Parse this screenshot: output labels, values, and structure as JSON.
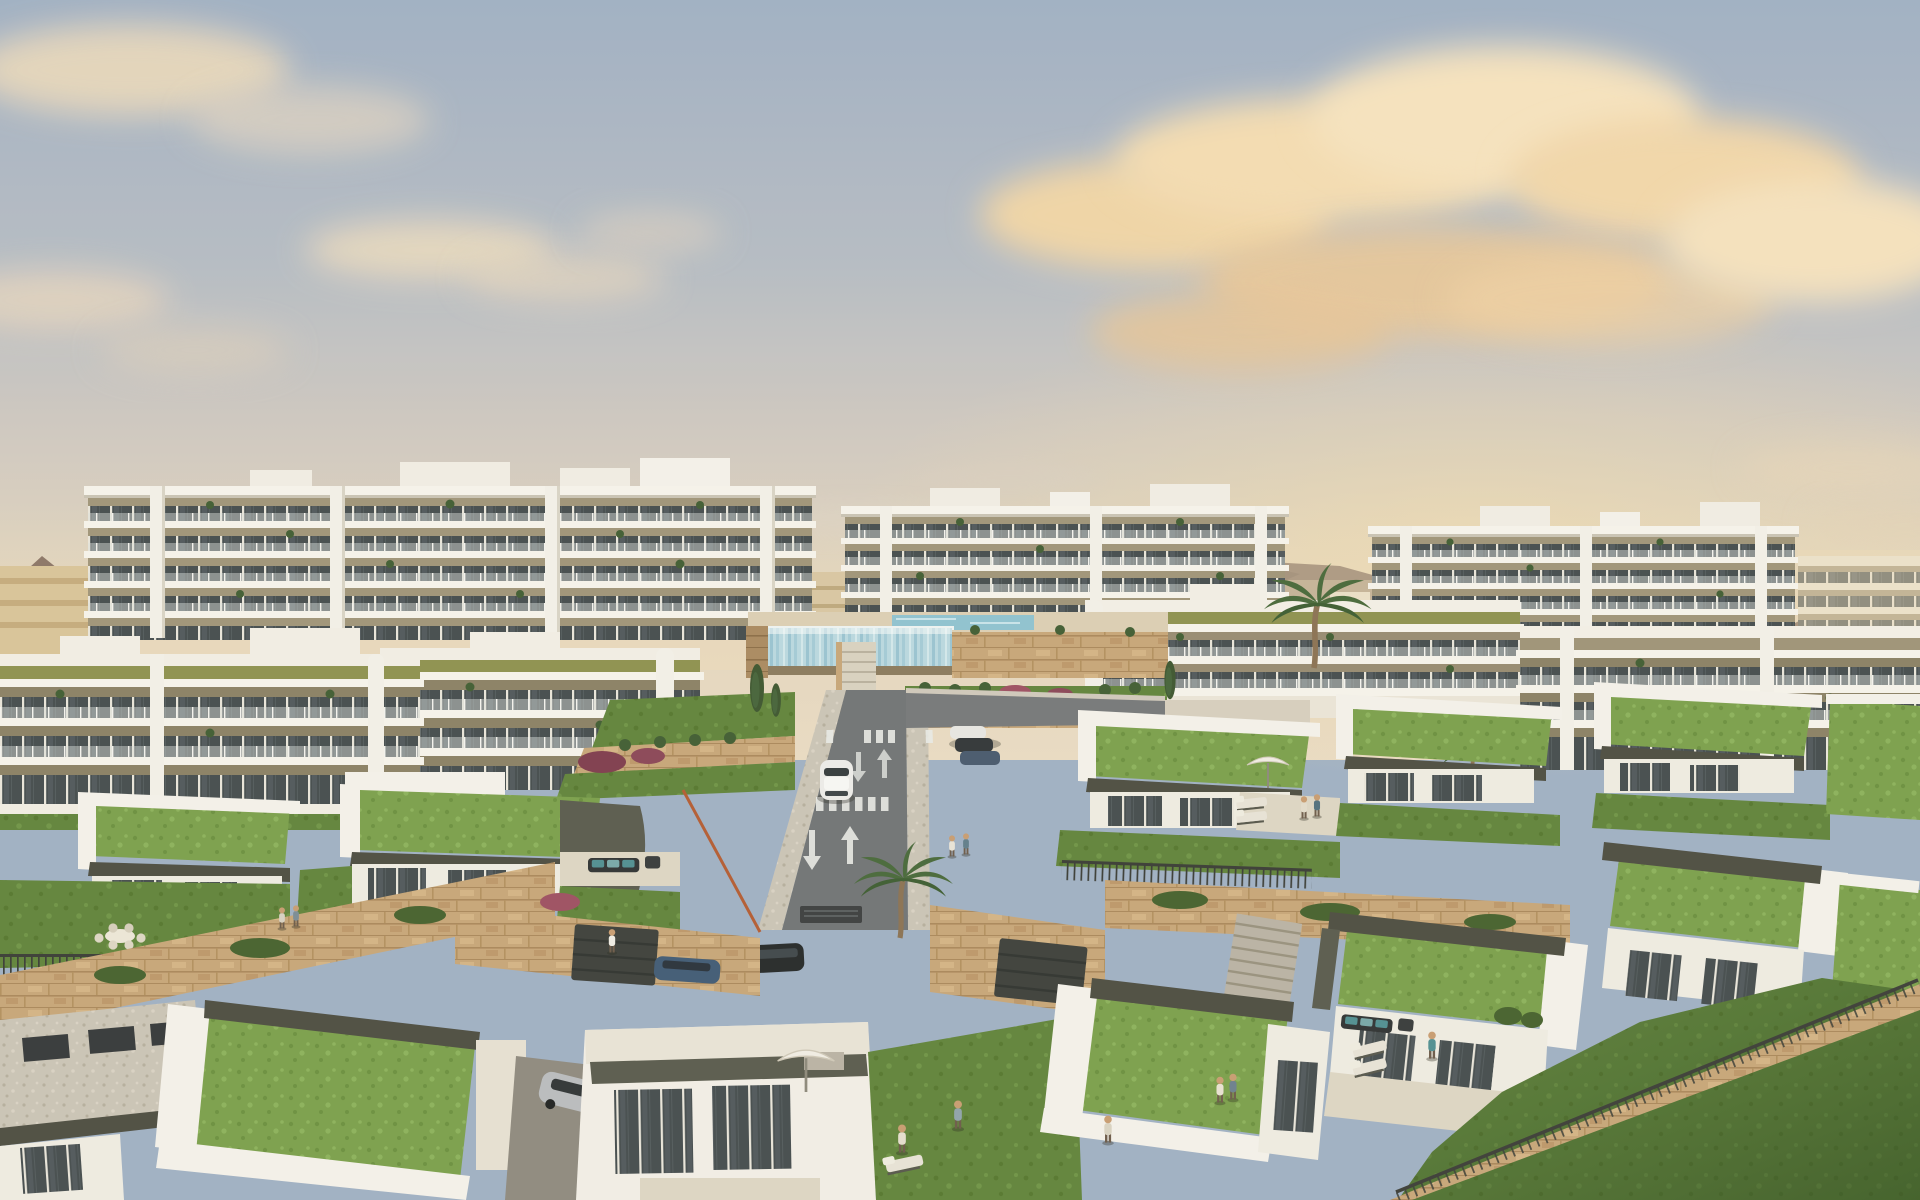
{
  "scene": {
    "title": "Hillside residential development — golden hour aerial render",
    "foreground": "terraced single-storey villas with planted green roofs, private lawns, stone retaining walls, fences, loungers and people",
    "midground": "access road with lane arrows and zebra crossings, white car, parked cars, palm trees, terraced gardens, infinity pool with glass wall",
    "background": "white multi-storey apartment blocks with wrap-around balconies, distant mountains, warm clouds",
    "counts": {
      "apartment_blocks": 7,
      "villas": 12,
      "people": 13,
      "cars": 7,
      "palm_trees": 3,
      "umbrellas": 3
    }
  },
  "palette": {
    "sky_top": "#9fb0c6",
    "sky_horizon": "#e8dcc4",
    "sun_glow": "#f6dfae",
    "cloud_warm": "#f2d8ac",
    "mountain": "#8b7568",
    "building_white": "#f6f4ee",
    "facade_band": "#9f947a",
    "glazing": "#434b4f",
    "olive_band": "#8d9150",
    "villa_fascia": "#4b4c42",
    "grass_roof": "#7aa04c",
    "lawn": "#5f833c",
    "stone": "#c7a67a",
    "road": "#6f7376",
    "marking": "#e9ebe9",
    "pool_glass": "#b9d8e2",
    "water": "#8ec2d2",
    "fence": "#3a3d38",
    "palm": "#46683a",
    "car_white": "#ececeb",
    "umbrella": "#f1eee6"
  }
}
